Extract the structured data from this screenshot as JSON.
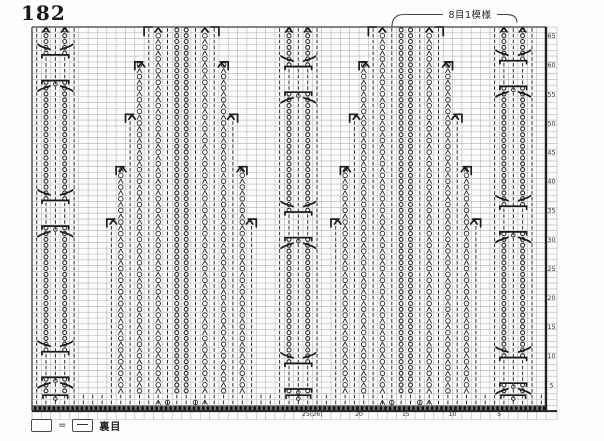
{
  "document": {
    "page_number": "182",
    "type": "knitting pattern chart"
  },
  "annotation": {
    "label": "8目1模様"
  },
  "legend": {
    "eq_sign": "=",
    "label": "裏目"
  },
  "colors": {
    "paper": "#fdfdfd",
    "ink": "#2b2b2b",
    "bold_ink": "#1a1a1a",
    "grid_line": "#b3b3b3",
    "border": "#3c3c3c",
    "thick_border": "#222222",
    "band_fill": "#707070",
    "band_dot": "#0e0e0e",
    "number": "#333333",
    "annotation_line": "#444444"
  },
  "grid": {
    "cols": 55,
    "rows": 66,
    "left": 32,
    "top": 27,
    "cell_w": 9.345,
    "cell_h": 5.82,
    "margin_right": 557,
    "margin_bottom": 419.5,
    "row_labels": [
      65,
      60,
      55,
      50,
      45,
      40,
      35,
      30,
      25,
      20,
      15,
      10,
      5
    ],
    "col_labels": [
      {
        "value": 5,
        "label": "5"
      },
      {
        "value": 10,
        "label": "10"
      },
      {
        "value": 15,
        "label": "15"
      },
      {
        "value": 20,
        "label": "20"
      },
      {
        "value": 25,
        "label": "25(26)"
      }
    ]
  },
  "panels": {
    "cable_panels": [
      {
        "id": "left-cable",
        "chain_cols": [
          1,
          3
        ],
        "gaps": [
          [
            58,
            61
          ],
          [
            33,
            36
          ],
          [
            7,
            10
          ]
        ]
      },
      {
        "id": "middle-cable",
        "chain_cols": [
          27,
          29
        ],
        "gaps": [
          [
            56,
            59
          ],
          [
            31,
            34
          ],
          [
            5,
            8
          ]
        ]
      },
      {
        "id": "right-cable",
        "chain_cols": [
          50,
          52
        ],
        "gaps": [
          [
            57,
            60
          ],
          [
            32,
            35
          ],
          [
            6,
            9
          ]
        ]
      }
    ],
    "pyramid_panels": [
      {
        "id": "left-pyramid",
        "center": 15.5
      },
      {
        "id": "right-pyramid",
        "center": 39.5
      }
    ],
    "half_width_steps": [
      {
        "min_row": 61,
        "hw": 4
      },
      {
        "min_row": 52,
        "hw": 5
      },
      {
        "min_row": 43,
        "hw": 6
      },
      {
        "min_row": 34,
        "hw": 7
      },
      {
        "min_row": 4,
        "hw": 8
      }
    ]
  },
  "symbols": {
    "blank_square": "purl (裏目)",
    "dash": "knit stitch",
    "circle": "yarn over",
    "person_glyph": "decrease",
    "bead_column": "twisted stitch / cable stitch",
    "bracket": "cable cross",
    "dotted_band": "cast-on edge row"
  }
}
